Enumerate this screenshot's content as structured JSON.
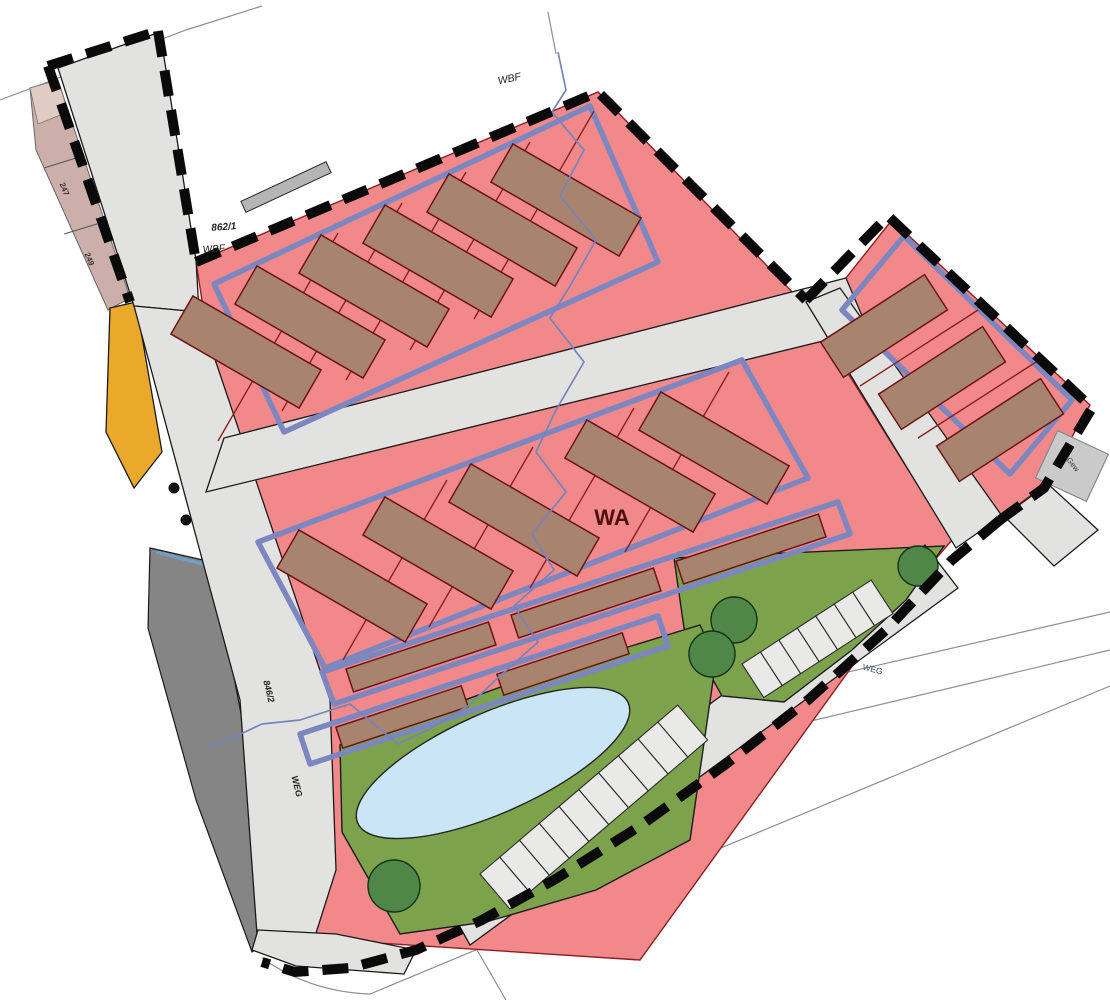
{
  "labels": {
    "zone_wa": "WA",
    "zone_wbf_top": "WBF",
    "zone_wbf_left": "WBF",
    "parcel_862_1": "862/1",
    "parcel_846_2": "846/2",
    "parcel_247": "247",
    "parcel_249": "249",
    "road_weg": "WEG",
    "path_weg": "WEG",
    "outbuilding_gew": "Gew"
  },
  "colors": {
    "residential_pink": "#F1888A",
    "building_brown": "#A8846E",
    "envelope_blue": "#7C86C0",
    "green_area": "#7DA24C",
    "tree_green": "#4E8747",
    "pond_blue": "#C9E5F6",
    "road_gray": "#E2E3E0",
    "dark_gray": "#858585",
    "yellow_area": "#EAA92B",
    "stall_gray": "#E9EAE7",
    "strip_pink": "#CDAFA9",
    "strip_pink_light": "#E0CBC5",
    "stream_blue": "#7683BD",
    "boundary_black": "#0A0A0A",
    "label_dark_red": "#4D0F0F"
  }
}
